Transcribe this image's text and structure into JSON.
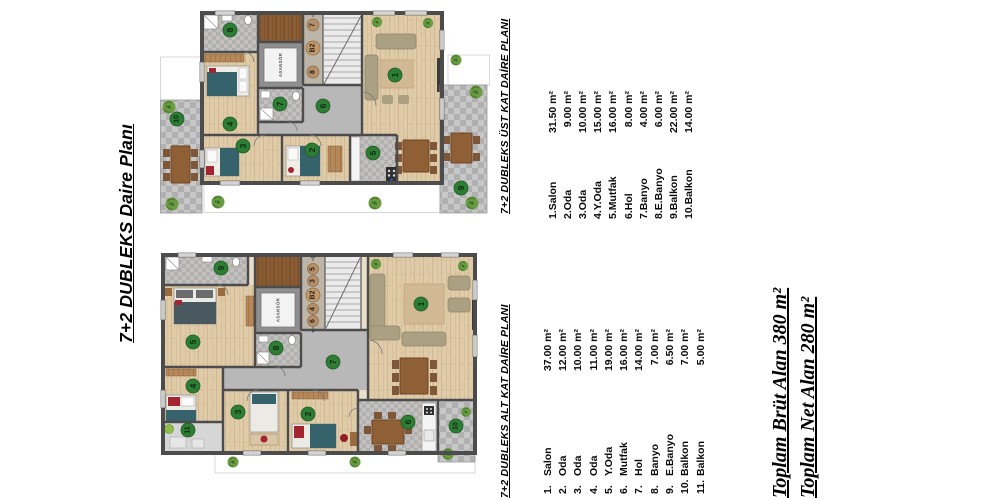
{
  "titles": {
    "main": "7+2 DUBLEKS  Daire Planı"
  },
  "plans": {
    "upper": {
      "title": "7+2 DUBLEKS ÜST KAT DAİRE PLANI",
      "rooms": [
        {
          "name": "1.Salon",
          "area": "31.50 m²"
        },
        {
          "name": "2.Oda",
          "area": "9.00 m²"
        },
        {
          "name": "3.Oda",
          "area": "10.00 m²"
        },
        {
          "name": "4.Y.Oda",
          "area": "15.00 m²"
        },
        {
          "name": "5.Mutfak",
          "area": "16.00 m²"
        },
        {
          "name": "6.Hol",
          "area": "8.00 m²"
        },
        {
          "name": "7.Banyo",
          "area": "4.00 m²"
        },
        {
          "name": "8.E.Banyo",
          "area": "6.00 m²"
        },
        {
          "name": "9.Balkon",
          "area": "22.00 m²"
        },
        {
          "name": "10.Balkon",
          "area": "14.00 m²"
        }
      ],
      "marks": {
        "salon": "1",
        "oda2": "2",
        "oda3": "3",
        "yoda": "4",
        "mutfak": "5",
        "hol": "6",
        "banyo": "7",
        "ebanyo": "8",
        "balkon9": "9",
        "balkon10": "10",
        "stair_upper": "7",
        "level": "B2",
        "stair_lower": "8",
        "elevator": "ASANSÖR"
      }
    },
    "lower": {
      "title": "7+2 DUBLEKS ALT KAT DAİRE PLANI",
      "rooms": [
        {
          "no": "1.",
          "name": "Salon",
          "area": "37.00 m²"
        },
        {
          "no": "2.",
          "name": "Oda",
          "area": "12.00 m²"
        },
        {
          "no": "3.",
          "name": "Oda",
          "area": "10.00 m²"
        },
        {
          "no": "4.",
          "name": "Oda",
          "area": "11.00 m²"
        },
        {
          "no": "5.",
          "name": "Y.Oda",
          "area": "19.00 m²"
        },
        {
          "no": "6.",
          "name": "Mutfak",
          "area": "16.00 m²"
        },
        {
          "no": "7.",
          "name": "Hol",
          "area": "14.00 m²"
        },
        {
          "no": "8.",
          "name": "Banyo",
          "area": "7.00 m²"
        },
        {
          "no": "9.",
          "name": "E.Banyo",
          "area": "6.50 m²"
        },
        {
          "no": "10.",
          "name": "Balkon",
          "area": "7.00 m²"
        },
        {
          "no": "11.",
          "name": "Balkon",
          "area": "5.00 m²"
        }
      ],
      "marks": {
        "salon": "1",
        "oda2": "2",
        "oda3": "3",
        "oda4": "4",
        "yoda": "5",
        "mutfak": "6",
        "hol": "7",
        "banyo": "8",
        "ebanyo": "9",
        "balkon10": "10",
        "balkon11": "11",
        "level": "B2",
        "unit5": "5",
        "unit3": "3",
        "unit4": "4",
        "unit6": "6",
        "elevator": "ASANSÖR"
      }
    }
  },
  "totals": {
    "brut_label": "Toplam Brüt Alan",
    "brut_value": "380 m²",
    "net_label": "Toplam Net Alan",
    "net_value": "280 m²"
  },
  "colors": {
    "wall": "#4c4c4c",
    "wood_floor": "#e0cba9",
    "tile_floor": "#bfbfbf",
    "room_marker_green": "#2e7d35",
    "stair_marker_brown": "#b5906b",
    "tree_green": "#699c43"
  }
}
